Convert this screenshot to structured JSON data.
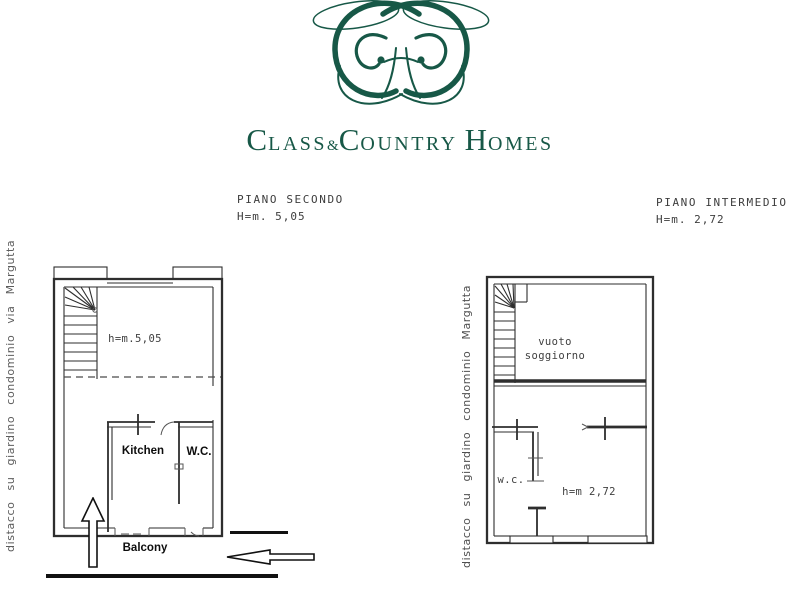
{
  "logo": {
    "color": "#175847",
    "wordmark": {
      "c1": "C",
      "lass": "LASS",
      "amp": "&",
      "c2": "C",
      "ountry": "OUNTRY",
      "h": "H",
      "omes": "OMES"
    }
  },
  "left_plan": {
    "title": "PIANO SECONDO",
    "height_note": "H=m. 5,05",
    "side_label": "distacco su giardino condominio via Margutta",
    "interior_height_label": "h=m.5,05",
    "kitchen_label": "Kitchen",
    "wc_label": "W.C.",
    "balcony_label": "Balcony"
  },
  "right_plan": {
    "title": "PIANO INTERMEDIO",
    "height_note": "H=m. 2,72",
    "side_label": "distacco su giardino condominio Margutta",
    "void_line1": "vuoto",
    "void_line2": "soggiorno",
    "wc_label": "w.c.",
    "interior_height_label": "h=m 2,72"
  }
}
